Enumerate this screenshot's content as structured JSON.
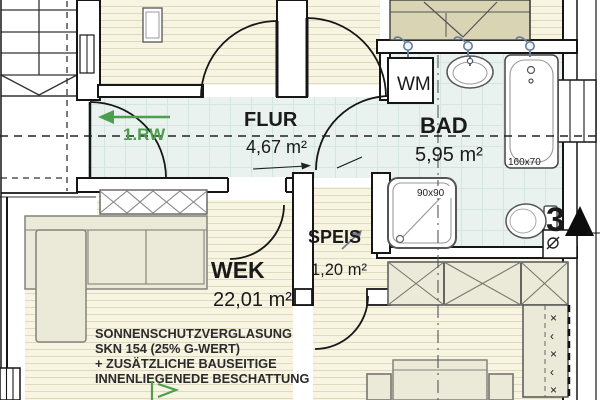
{
  "rooms": {
    "flur": {
      "label": "FLUR",
      "area": "4,67 m²"
    },
    "bad": {
      "label": "BAD",
      "area": "5,95 m²"
    },
    "speis": {
      "label": "SPEIS",
      "area": "1,20 m²"
    },
    "wek": {
      "label": "WEK",
      "area": "22,01 m²"
    }
  },
  "fixtures": {
    "washing_machine": "WM",
    "bathtub_size": "160x70",
    "shower_size": "90x90"
  },
  "annotations": {
    "escape_route": "1.RW",
    "sheet_number": "3",
    "glazing_note_lines": [
      "SONNENSCHUTZVERGLASUNG",
      "SKN 154 (25% G-WERT)",
      "+ ZUSÄTZLICHE BAUSEITIGE",
      "INNENLIEGENEDE BESCHATTUNG"
    ],
    "wardrobe_marks": [
      "×",
      "‹",
      "×",
      "‹",
      "×"
    ]
  },
  "colors": {
    "tile": "#e9f2ee",
    "tile_grid": "#d4e6df",
    "floor": "#f7f4e2",
    "floor_stripe": "#dfdabe",
    "furniture": "#ebe9d8",
    "wardrobe_tan": "#d9d4b4",
    "escape_green": "#4e9e50",
    "fixture_blue": "#667d99",
    "wall_black": "#161616"
  }
}
